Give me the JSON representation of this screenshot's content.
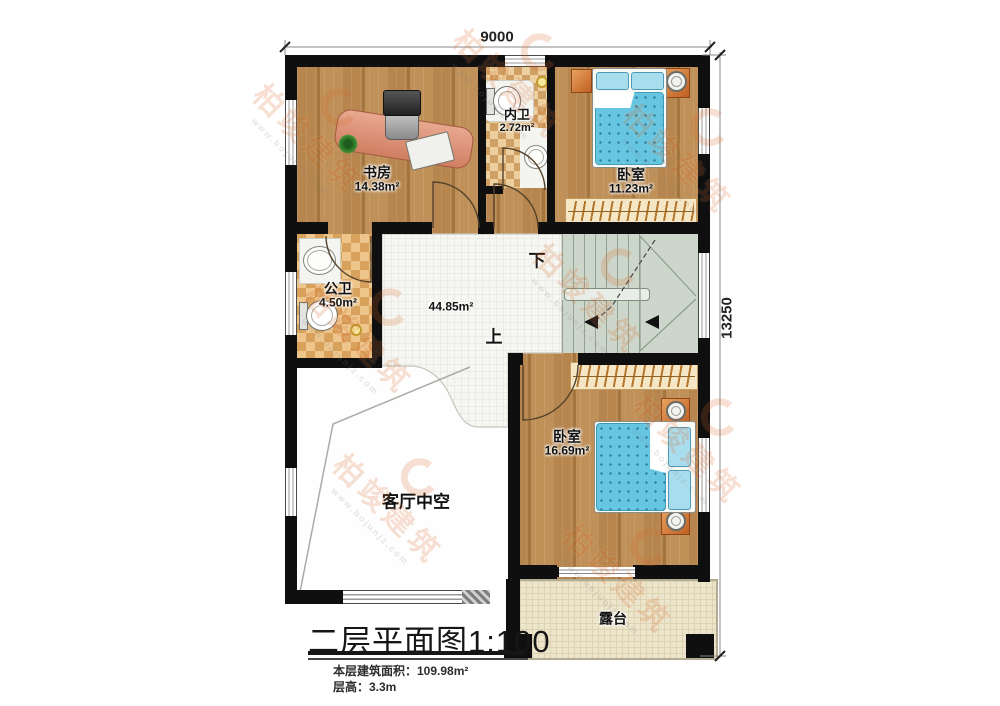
{
  "watermark": {
    "brand": "柏竣建筑",
    "url": "www.bojunjz.com"
  },
  "dimensions": {
    "width": "9000",
    "height": "13250"
  },
  "rooms": {
    "study": {
      "name": "书房",
      "area": "14.38m²"
    },
    "inner_bath": {
      "name": "内卫",
      "area": "2.72m²"
    },
    "bedroom_top": {
      "name": "卧室",
      "area": "11.23m²"
    },
    "public_bath": {
      "name": "公卫",
      "area": "4.50m²"
    },
    "hall": {
      "area": "44.85m²"
    },
    "void": {
      "name": "客厅中空"
    },
    "bedroom_bottom": {
      "name": "卧室",
      "area": "16.69m²"
    },
    "terrace": {
      "name": "露台"
    }
  },
  "stairs": {
    "down_label": "下",
    "up_label": "上"
  },
  "titleblock": {
    "title": "二层平面图1:100",
    "area_note": "本层建筑面积：109.98m²",
    "height_note": "层高：3.3m"
  },
  "colors": {
    "wall": "#0f0f0f",
    "wood": "#b2824a",
    "bath_tile": "#d8a15c",
    "stair": "#ccd6ca",
    "bed": "#66c6e2",
    "terrace": "#ece4cb",
    "watermark": "#d86a2a"
  }
}
